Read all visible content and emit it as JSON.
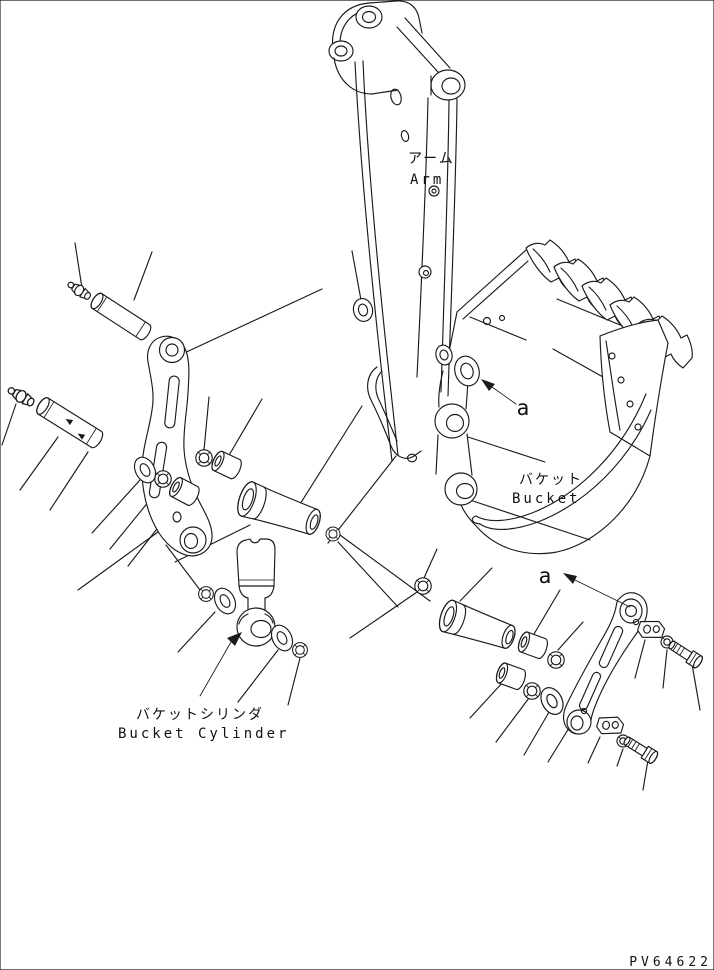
{
  "page": {
    "width": 714,
    "height": 970,
    "background": "#ffffff",
    "ink": "#1b1b1b"
  },
  "drawing": {
    "code": "PV64622",
    "labels": {
      "arm_jp": "アーム",
      "arm_en": "Arm",
      "bucket_jp": "バケット",
      "bucket_en": "Bucket",
      "bucket_cylinder_jp": "バケットシリンダ",
      "bucket_cylinder_en": "Bucket Cylinder"
    },
    "view_markers": [
      {
        "label": "a"
      },
      {
        "label": "a"
      }
    ],
    "depicted_parts": [
      "arm",
      "bucket",
      "bucket tooth (x5)",
      "side cutter",
      "side link plate (left)",
      "side link plate (right)",
      "center link (x2)",
      "bucket cylinder rod eye",
      "pivot pin (x2)",
      "grease fitting (x2)",
      "bushing (x4)",
      "o-ring (x8)",
      "thrust washer (x4)",
      "pin lock block (x2)",
      "lock bolt (x2)",
      "lock washer (x2)"
    ]
  }
}
